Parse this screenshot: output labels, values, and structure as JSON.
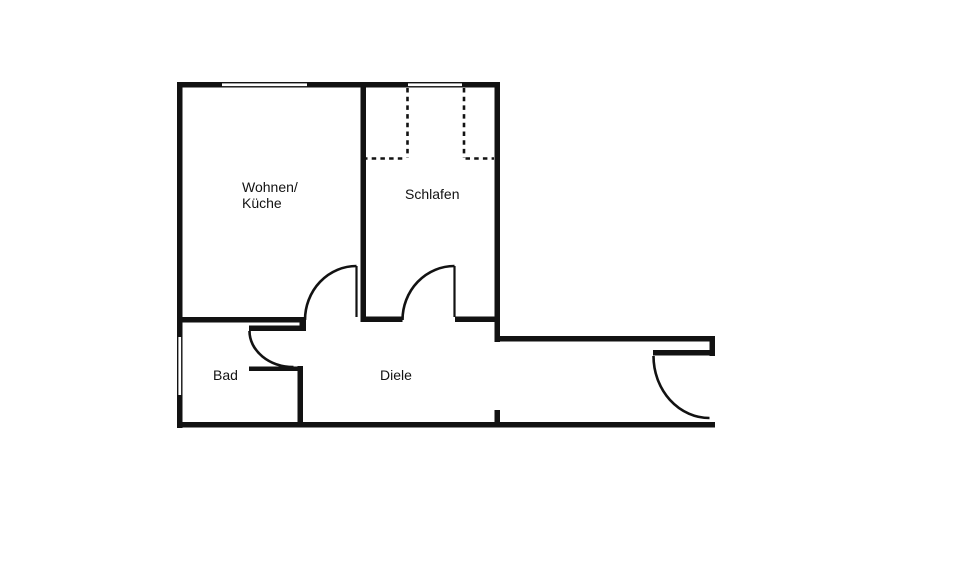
{
  "plan": {
    "type": "floorplan",
    "rooms": [
      {
        "id": "wohnen-kueche",
        "label_lines": [
          "Wohnen/",
          "Küche"
        ]
      },
      {
        "id": "schlafen",
        "label": "Schlafen"
      },
      {
        "id": "bad",
        "label": "Bad"
      },
      {
        "id": "diele",
        "label": "Diele"
      }
    ],
    "features": {
      "windows": [
        "window-top-wohnen-kueche",
        "window-top-schlafen",
        "window-left-bad"
      ],
      "doors": [
        "door-wohnen-kueche",
        "door-schlafen",
        "door-bad",
        "door-entrance"
      ],
      "dashed_overlay": "dashed-outline-schlafen"
    }
  },
  "colors": {
    "wall": "#121212",
    "background": "#ffffff"
  }
}
